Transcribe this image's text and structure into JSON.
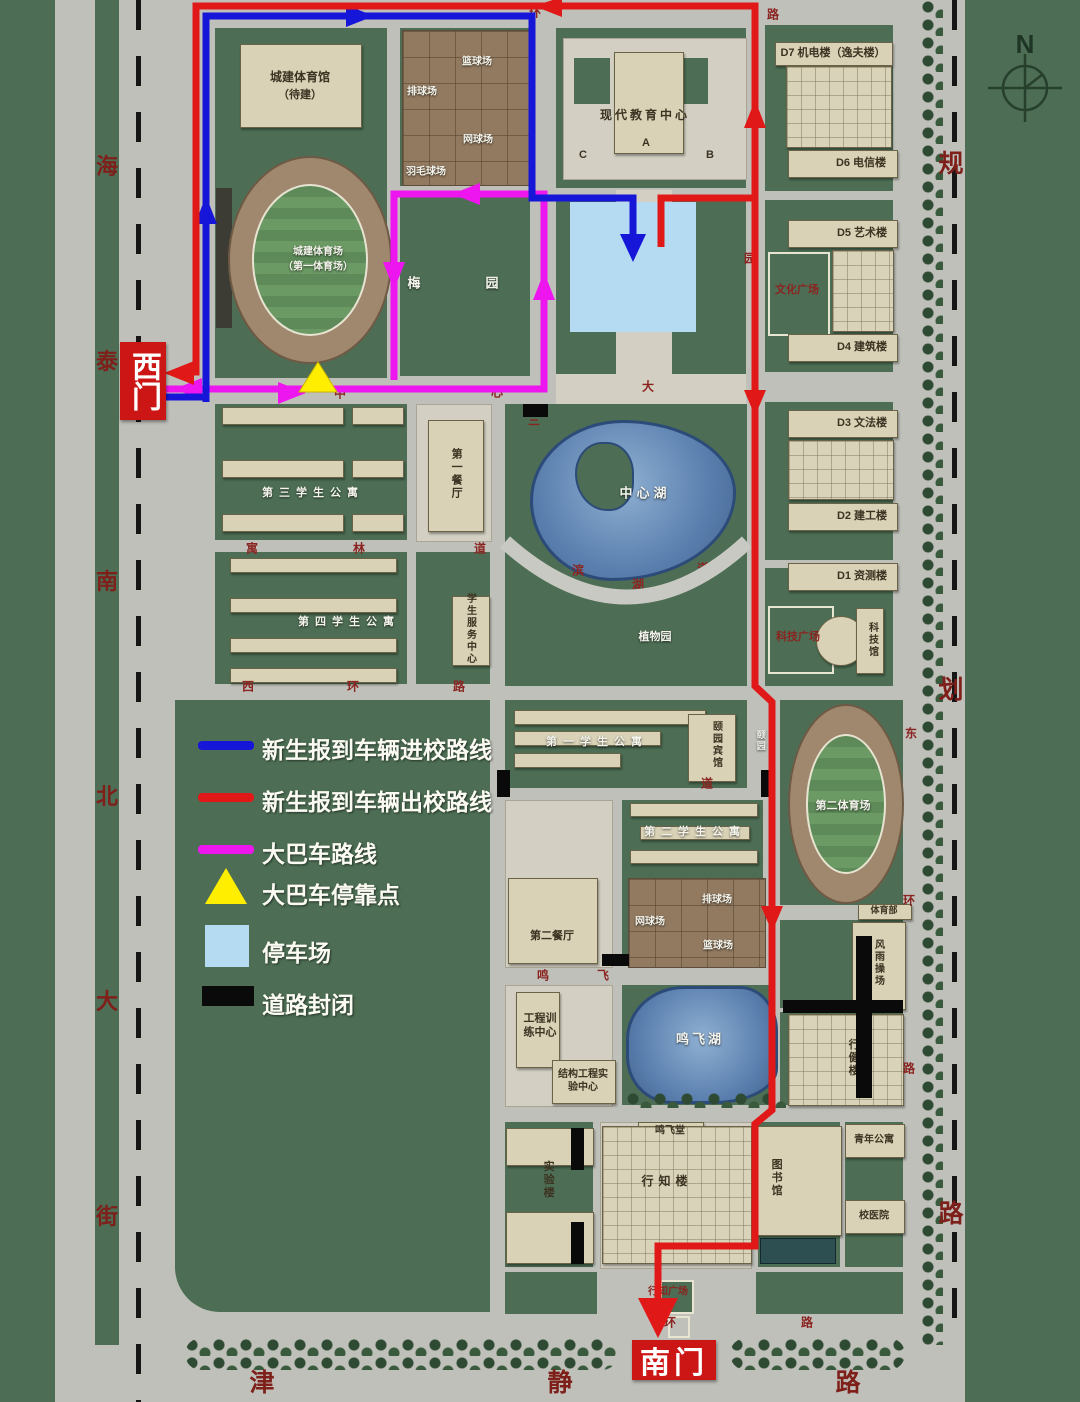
{
  "map": {
    "compass_n": "N",
    "gates": {
      "west": "西门",
      "south": "南门"
    },
    "streets": {
      "left": [
        "海",
        "泰",
        "南",
        "北",
        "大",
        "街"
      ],
      "right": [
        "规",
        "划",
        "路"
      ],
      "bottom": [
        "津",
        "静",
        "路"
      ]
    },
    "legend": {
      "items": [
        {
          "key": "enter",
          "swatch": "line",
          "color": "#1616d8",
          "label": "新生报到车辆进校路线"
        },
        {
          "key": "exit",
          "swatch": "line",
          "color": "#e01818",
          "label": "新生报到车辆出校路线"
        },
        {
          "key": "bus",
          "swatch": "line",
          "color": "#ee16ee",
          "label": "大巴车路线"
        },
        {
          "key": "busstop",
          "swatch": "triangle",
          "color": "#ffee00",
          "label": "大巴车停靠点"
        },
        {
          "key": "parking",
          "swatch": "square",
          "color": "#b4dbf1",
          "label": "停车场"
        },
        {
          "key": "closed",
          "swatch": "bar",
          "color": "#0a0a0a",
          "label": "道路封闭"
        }
      ]
    },
    "labels": {
      "gym": "城建体育馆",
      "gym2": "（待建）",
      "courtN_basketball": "篮球场",
      "courtN_volleyball": "排球场",
      "courtN_tennis": "网球场",
      "courtN_badminton": "羽毛球场",
      "stadium1a": "城建体育场",
      "stadium1b": "（第一体育场）",
      "meiyuan": "梅　园",
      "edu_center": "现代教育中心",
      "blockA": "A",
      "blockB": "B",
      "blockC": "C",
      "d7": "D7 机电楼（逸夫楼）",
      "d6": "D6 电信楼",
      "d5": "D5 艺术楼",
      "culture_plaza": "文化广场",
      "d4": "D4 建筑楼",
      "d3": "D3 文法楼",
      "d2": "D2 建工楼",
      "d1": "D1 资测楼",
      "tech_plaza": "科技广场",
      "tech_museum": "科技馆",
      "apt3": "第三学生公寓",
      "canteen1": "第一餐厅",
      "apt4": "第四学生公寓",
      "service": "学生服务中心",
      "central_lake": "中心湖",
      "botanic": "植物园",
      "apt1": "第一学生公寓",
      "hotel": "颐园宾馆",
      "yiyuan": "颐园",
      "apt2": "第二学生公寓",
      "canteen2": "第二餐厅",
      "courtS_tennis": "网球场",
      "courtS_volleyball": "排球场",
      "courtS_basketball": "篮球场",
      "stadium2": "第二体育场",
      "pe_dept": "体育部",
      "windrain": "风雨操场",
      "eng_training": "工程训练中心",
      "struct_lab": "结构工程实验中心",
      "mingfei_lake": "鸣飞湖",
      "mingfei_hall": "鸣飞堂",
      "xingzhi": "行知楼",
      "lab": "实验楼",
      "library": "图书馆",
      "youth_apt": "青年公寓",
      "hospital": "校医院",
      "xingjian": "行健楼",
      "xingzhi_plaza": "行知广场"
    },
    "road_chars": [
      "环",
      "路",
      "中",
      "心",
      "大",
      "寓",
      "林",
      "道",
      "西",
      "环",
      "路",
      "滨",
      "湖",
      "道",
      "三",
      "园",
      "东",
      "环",
      "路",
      "鸣",
      "飞",
      "环",
      "路",
      "道"
    ]
  },
  "route_colors": {
    "enter": "#1616d8",
    "exit": "#e01818",
    "bus": "#ee16ee",
    "bus_stop": "#ffee00",
    "parking": "#b4dbf1",
    "closed": "#0a0a0a"
  }
}
